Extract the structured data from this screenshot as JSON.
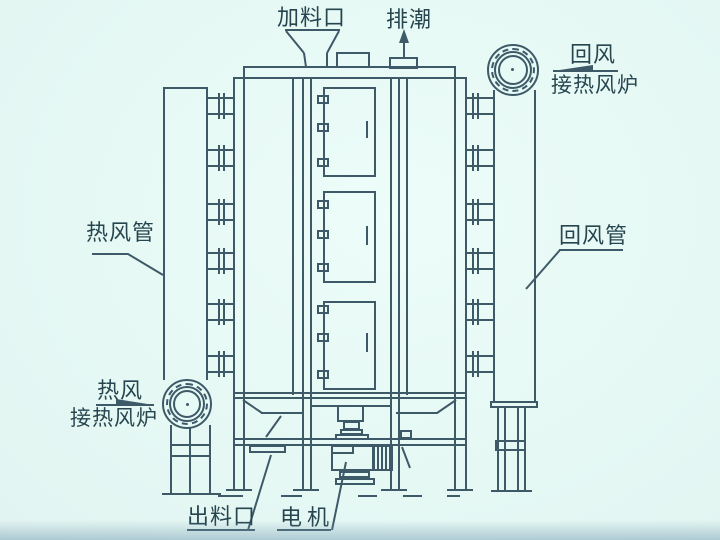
{
  "colors": {
    "background": "#e5f8f4",
    "line": "#3e5a68",
    "text": "#26454f",
    "bottom_shade": "#7f9eb4"
  },
  "labels": {
    "feed_inlet": "加料口",
    "moisture_exhaust": "排潮",
    "return_air": "回风",
    "return_air_to_furnace": "接热风炉",
    "return_air_pipe": "回风管",
    "hot_air_pipe": "热风管",
    "hot_air": "热风",
    "hot_air_to_furnace": "接热风炉",
    "discharge_outlet": "出料口",
    "motor": "电机"
  }
}
